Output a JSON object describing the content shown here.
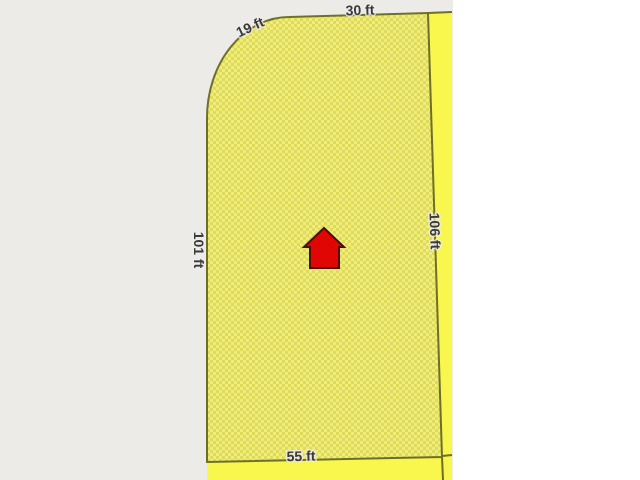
{
  "parcel": {
    "dimensions": {
      "curve": "19 ft",
      "top": "30 ft",
      "left": "101 ft",
      "right": "106 ft",
      "bottom": "55 ft"
    },
    "marker": "house-icon"
  },
  "colors": {
    "background_left": "#edebe8",
    "background_right": "#ffffff",
    "parcel_hatch_light": "#efec80",
    "parcel_hatch_dark": "#dfdb58",
    "adjacent_parcel": "#f9f64d",
    "boundary_line": "#6e7028",
    "label_text": "#3a3a3a",
    "house_fill": "#df0603",
    "house_outline": "#4a0d0a"
  }
}
